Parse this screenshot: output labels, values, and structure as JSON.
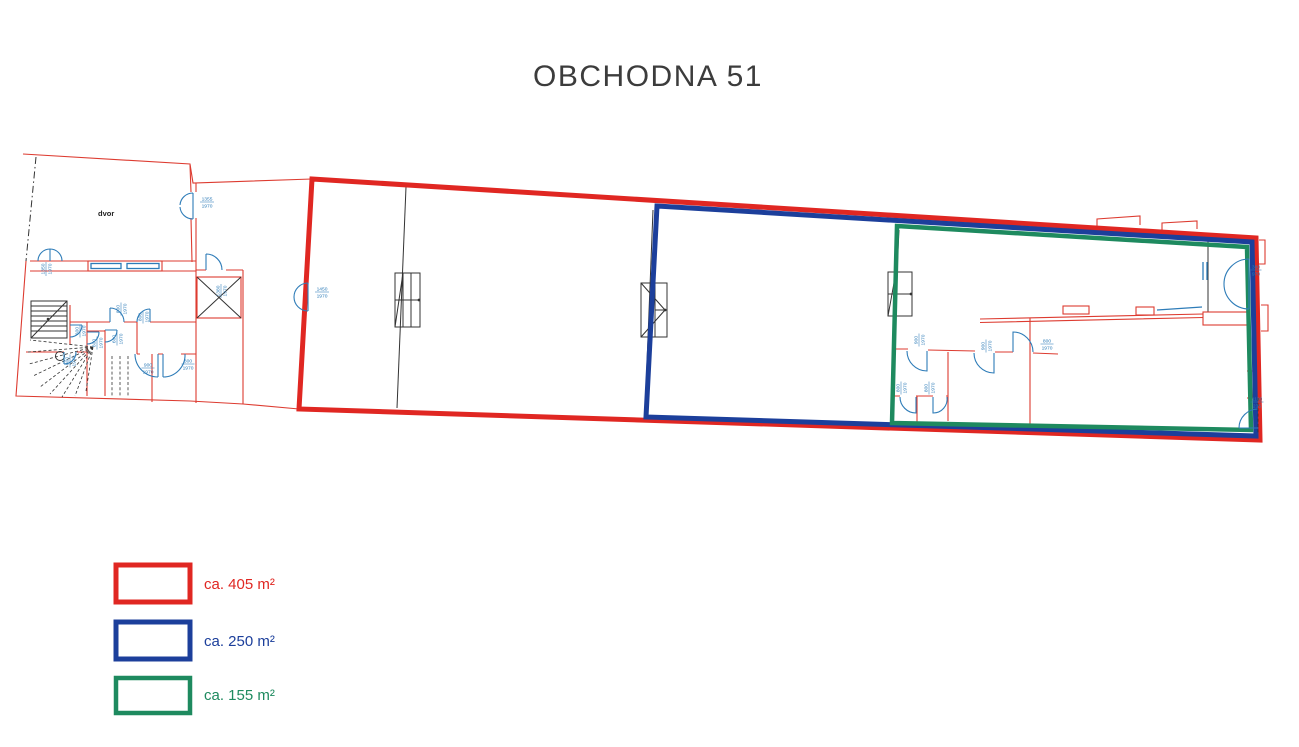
{
  "title": "OBCHODNA 51",
  "plan": {
    "courtyard_label": "dvor",
    "doors": [
      "1355/1970",
      "1350/1970",
      "1380/1970",
      "1450/1970",
      "800/1970",
      "800/1970",
      "600/1970",
      "600/1970",
      "600/1970",
      "800/1970",
      "900/1970",
      "800/1970",
      "900/1970",
      "900/1970",
      "800/1970",
      "800/1970",
      "800/1970",
      "380/970",
      "1100/235"
    ]
  },
  "legend": {
    "items": [
      {
        "label": "ca. 405 m²",
        "color": "#e02722"
      },
      {
        "label": "ca. 250 m²",
        "color": "#1c3f9b"
      },
      {
        "label": "ca. 155 m²",
        "color": "#1e8a5f"
      }
    ]
  }
}
